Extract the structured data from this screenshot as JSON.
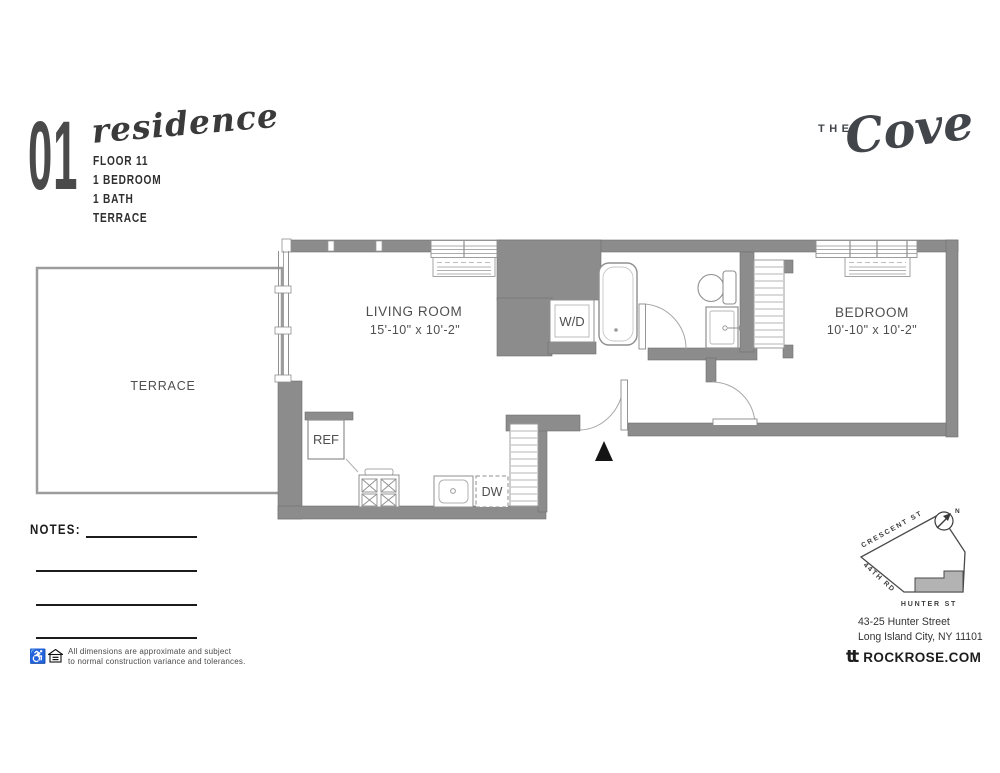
{
  "header": {
    "unit_number": "01",
    "unit_name": "residence",
    "line1": "FLOOR 11",
    "line2": "1 BEDROOM",
    "line3": "1 BATH",
    "line4": "TERRACE"
  },
  "brand": {
    "prefix": "THE",
    "name": "Cove"
  },
  "plan": {
    "living_room_label": "LIVING ROOM",
    "living_room_dims": "15'-10\" x 10'-2\"",
    "bedroom_label": "BEDROOM",
    "bedroom_dims": "10'-10\" x 10'-2\"",
    "terrace_label": "TERRACE",
    "washer_dryer_label": "W/D",
    "refrigerator_label": "REF",
    "dishwasher_label": "DW"
  },
  "notes": {
    "label": "NOTES:"
  },
  "disclaimer": {
    "line1": "All dimensions are approximate and subject",
    "line2": "to normal construction variance and tolerances."
  },
  "site_map": {
    "street_top": "CRESCENT ST",
    "street_side": "44TH RD",
    "street_bottom": "HUNTER ST",
    "north_label": "N"
  },
  "contact": {
    "address_line1": "43-25 Hunter Street",
    "address_line2": "Long Island City, NY 11101",
    "logo_text": "tt",
    "website": "ROCKROSE.COM"
  },
  "colors": {
    "wall": "#8c8c8c",
    "accent_dark": "#3d3d3d"
  }
}
